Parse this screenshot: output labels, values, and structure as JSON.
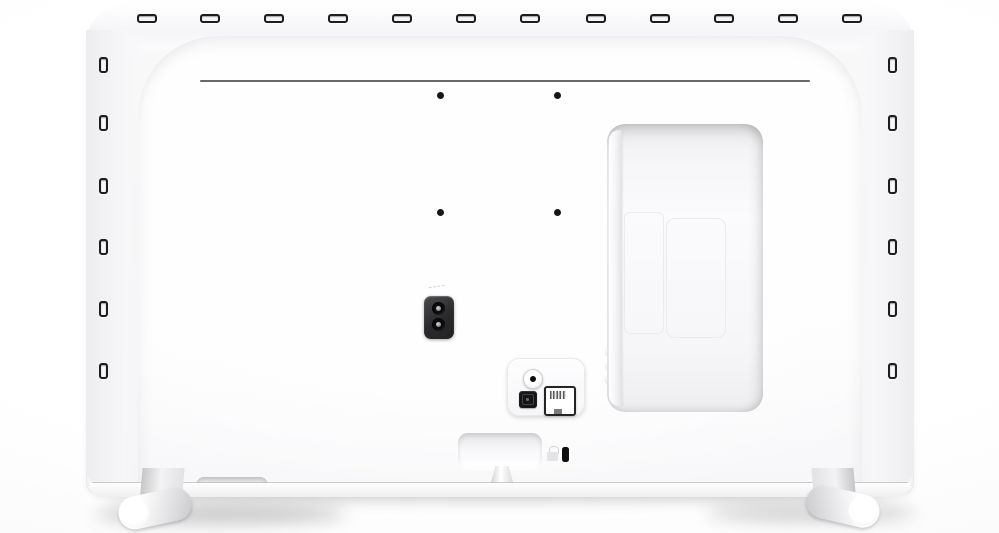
{
  "scene": {
    "description": "rear view of a white flat-screen television",
    "background_color": "#fcfcfd",
    "shadow_color": "rgba(0,0,0,0.18)"
  },
  "tv": {
    "body_color": "#f5f5f7",
    "panel_color": "#fcfcfd",
    "slot_color": "#1d1d1f",
    "top_slots": {
      "count": 12,
      "y": 14,
      "centers_x": [
        147,
        210,
        274,
        338,
        402,
        466,
        530,
        596,
        660,
        724,
        788,
        852
      ]
    },
    "left_slots": {
      "count": 6,
      "x": 99,
      "tops_y": [
        57,
        115,
        178,
        239,
        301,
        363
      ]
    },
    "right_slots": {
      "count": 6,
      "x": 888,
      "tops_y": [
        57,
        115,
        178,
        239,
        301,
        363
      ]
    },
    "vent_groove": {
      "x": 200,
      "y": 80,
      "width": 610
    },
    "vesa_holes": {
      "count": 4,
      "hole_color": "#161618",
      "centers": [
        [
          440,
          95
        ],
        [
          557,
          95
        ],
        [
          440,
          212
        ],
        [
          557,
          212
        ]
      ]
    },
    "power_inlet": {
      "type": "two-pin-ac-socket",
      "pin_count": 2,
      "body_color": "#2a2a2c"
    },
    "connection_bay": {
      "cable_clips": 3,
      "clip_tops_y": [
        347,
        361,
        375
      ],
      "inner_divider_y": [
        249,
        291
      ]
    },
    "side_ports": [
      {
        "id": "antenna-jack",
        "shape": "round"
      },
      {
        "id": "optical-audio-port",
        "shape": "square",
        "color": "#151517"
      },
      {
        "id": "ethernet-port",
        "shape": "rj45"
      }
    ],
    "controls": {
      "power_stick": 1,
      "bottom_recess": 1
    },
    "security": {
      "kensington_slot": 1,
      "lock_icon": 1
    },
    "feet": {
      "count": 2,
      "style": "cylindrical-bar",
      "color": "#e6e6e8"
    }
  }
}
